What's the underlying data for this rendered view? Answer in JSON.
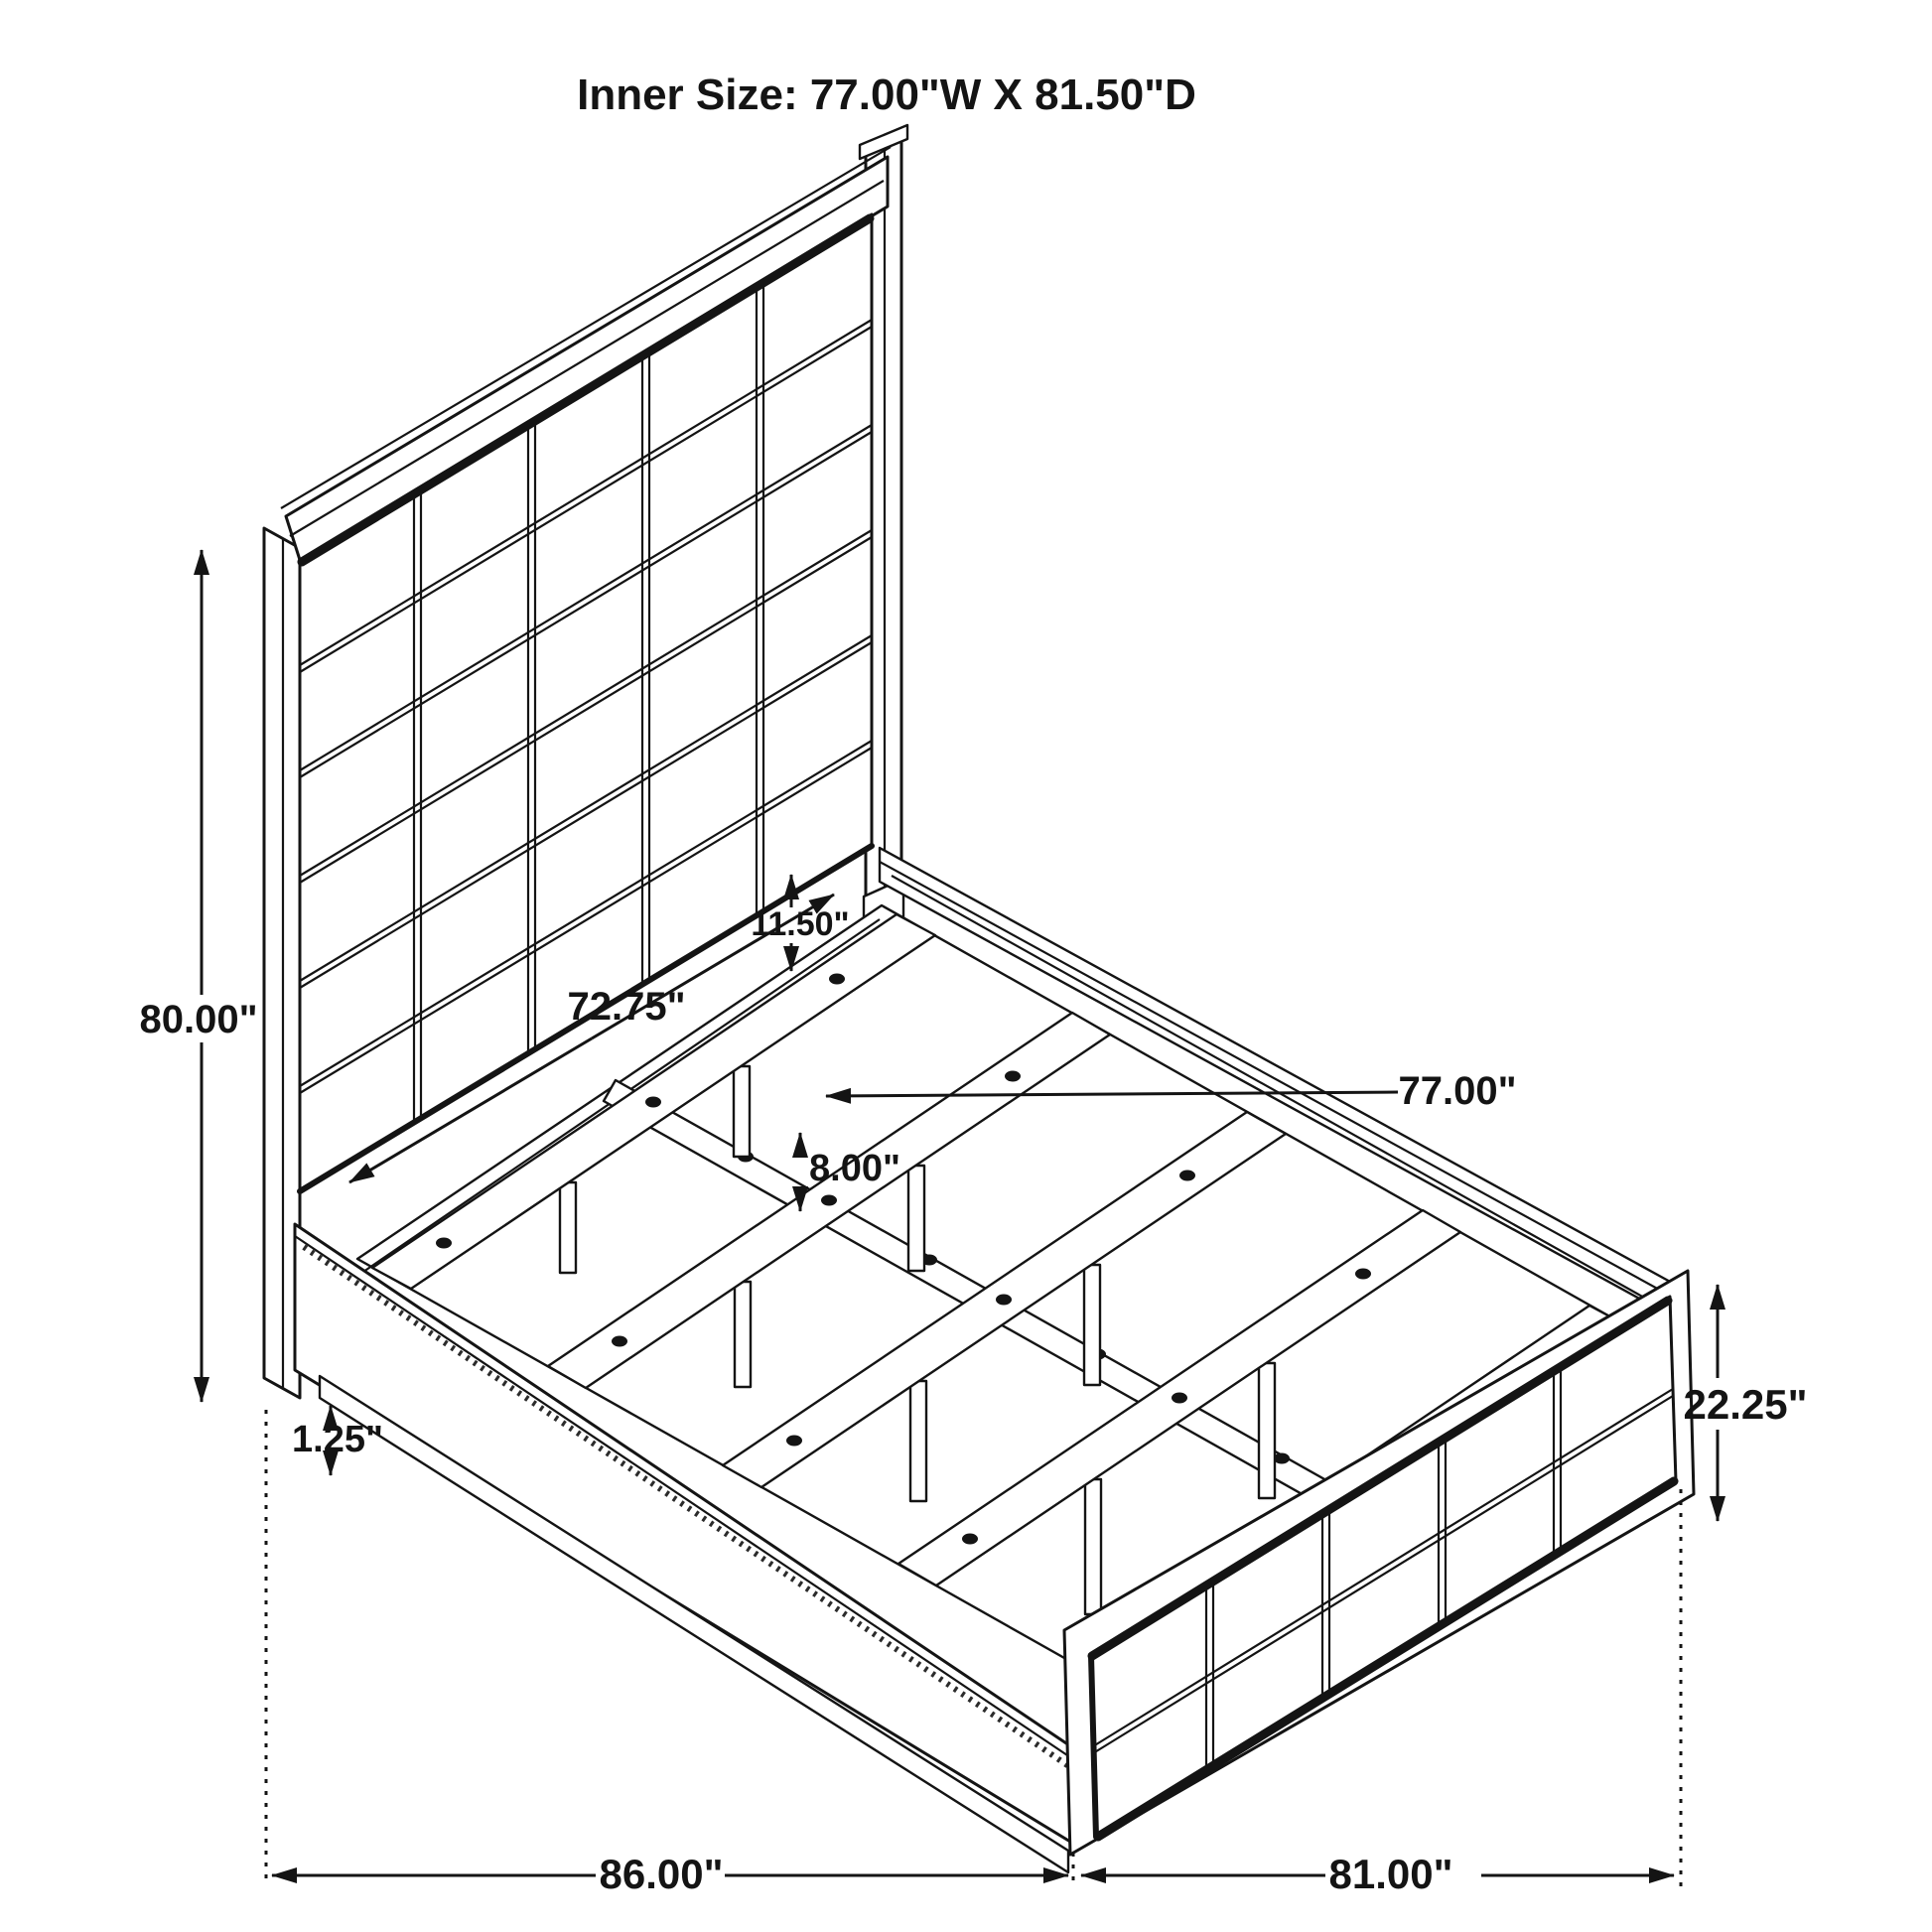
{
  "page": {
    "background": "#ffffff",
    "line_color": "#141414"
  },
  "title": {
    "text": "Inner Size: 77.00\"W X 81.50\"D"
  },
  "dimensions": {
    "headboard_height": "80.00\"",
    "rail_gap": "11.50\"",
    "headboard_inner_width": "72.75\"",
    "slat_inner_width": "77.00\"",
    "slat_leg_height": "8.00\"",
    "base_clearance": "1.25\"",
    "footboard_height": "22.25\"",
    "overall_length": "86.00\"",
    "overall_width": "81.00\""
  }
}
